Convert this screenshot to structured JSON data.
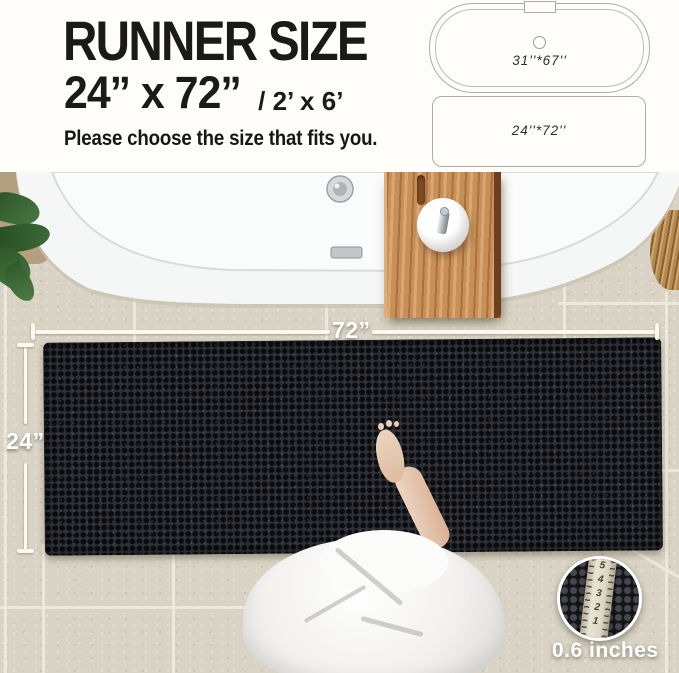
{
  "header": {
    "title": "RUNNER SIZE",
    "size_primary": "24”  x 72”",
    "size_secondary": "/ 2’ x 6’",
    "subtitle": "Please choose the size that fits you."
  },
  "diagrams": {
    "bathtub_size_label": "31''*67''",
    "runner_size_label": "24''*72''"
  },
  "photo": {
    "width_label": "72”",
    "height_label": "24”",
    "thickness_label": "0.6 inches",
    "ruler_numbers": [
      "5",
      "4",
      "3",
      "2",
      "1"
    ]
  },
  "colors": {
    "rug": "#26272b",
    "tile": "#d8d3c4",
    "wood": "#c68c55",
    "annotation": "#ffffff",
    "text": "#1b1a18"
  }
}
